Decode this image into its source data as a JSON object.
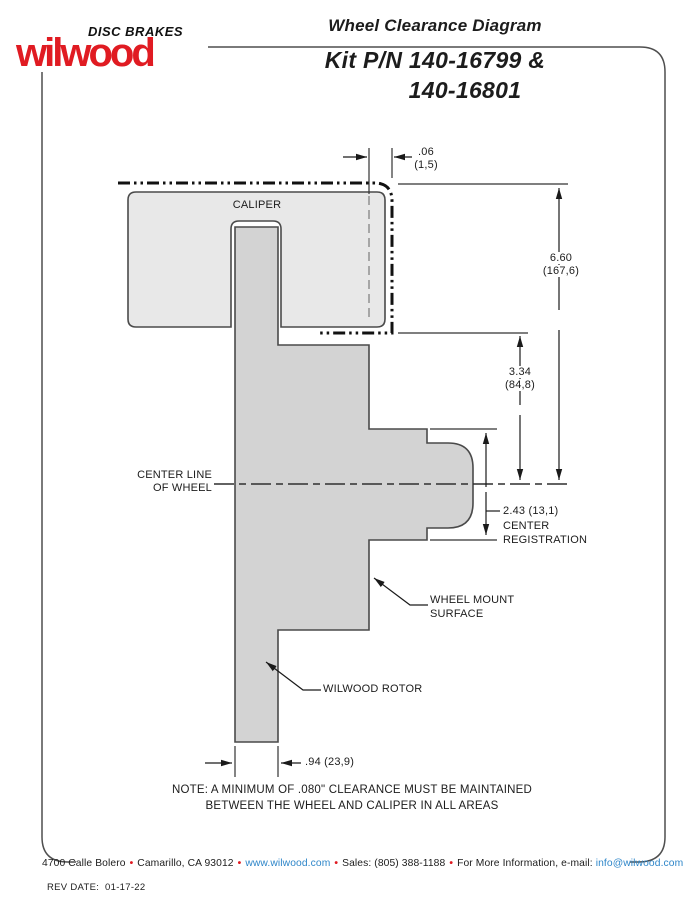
{
  "brand": {
    "disc_brakes": "DISC BRAKES",
    "wilwood": "wilwood",
    "red": "#e01b22"
  },
  "header": {
    "title": "Wheel Clearance Diagram",
    "kit_line1": "Kit P/N 140-16799 &",
    "kit_line2": "140-16801"
  },
  "diagram": {
    "caliper_label": "CALIPER",
    "centerline_line1": "CENTER LINE",
    "centerline_line2": "OF WHEEL",
    "dims": {
      "clearance_in": ".06",
      "clearance_mm": "(1,5)",
      "wheel_depth_in": "6.60",
      "wheel_depth_mm": "(167,6)",
      "mount_to_center_in": "3.34",
      "mount_to_center_mm": "(84,8)",
      "center_registration_value": "2.43 (13,1)",
      "center_registration_l1": "CENTER",
      "center_registration_l2": "REGISTRATION",
      "rotor_width": ".94 (23,9)"
    },
    "labels": {
      "wheel_mount_l1": "WHEEL MOUNT",
      "wheel_mount_l2": "SURFACE",
      "rotor": "WILWOOD ROTOR"
    }
  },
  "note": {
    "line1": "NOTE: A MINIMUM OF .080\" CLEARANCE MUST BE MAINTAINED",
    "line2": "BETWEEN THE WHEEL AND CALIPER IN ALL AREAS"
  },
  "footer": {
    "address": "4700 Calle Bolero",
    "city": "Camarillo, CA 93012",
    "site": "www.wilwood.com",
    "sales": "Sales: (805) 388-1188",
    "info": "For More Information, e-mail:",
    "email": "info@wilwood.com",
    "bullet": "•"
  },
  "rev": {
    "label": "REV DATE:",
    "date": "01-17-22"
  },
  "colors": {
    "brand_red": "#e01b22",
    "link_blue": "#2e86c9",
    "caliper_fill": "#e8e8e8",
    "rotor_fill": "#d3d3d3",
    "line": "#3c3c3c"
  }
}
